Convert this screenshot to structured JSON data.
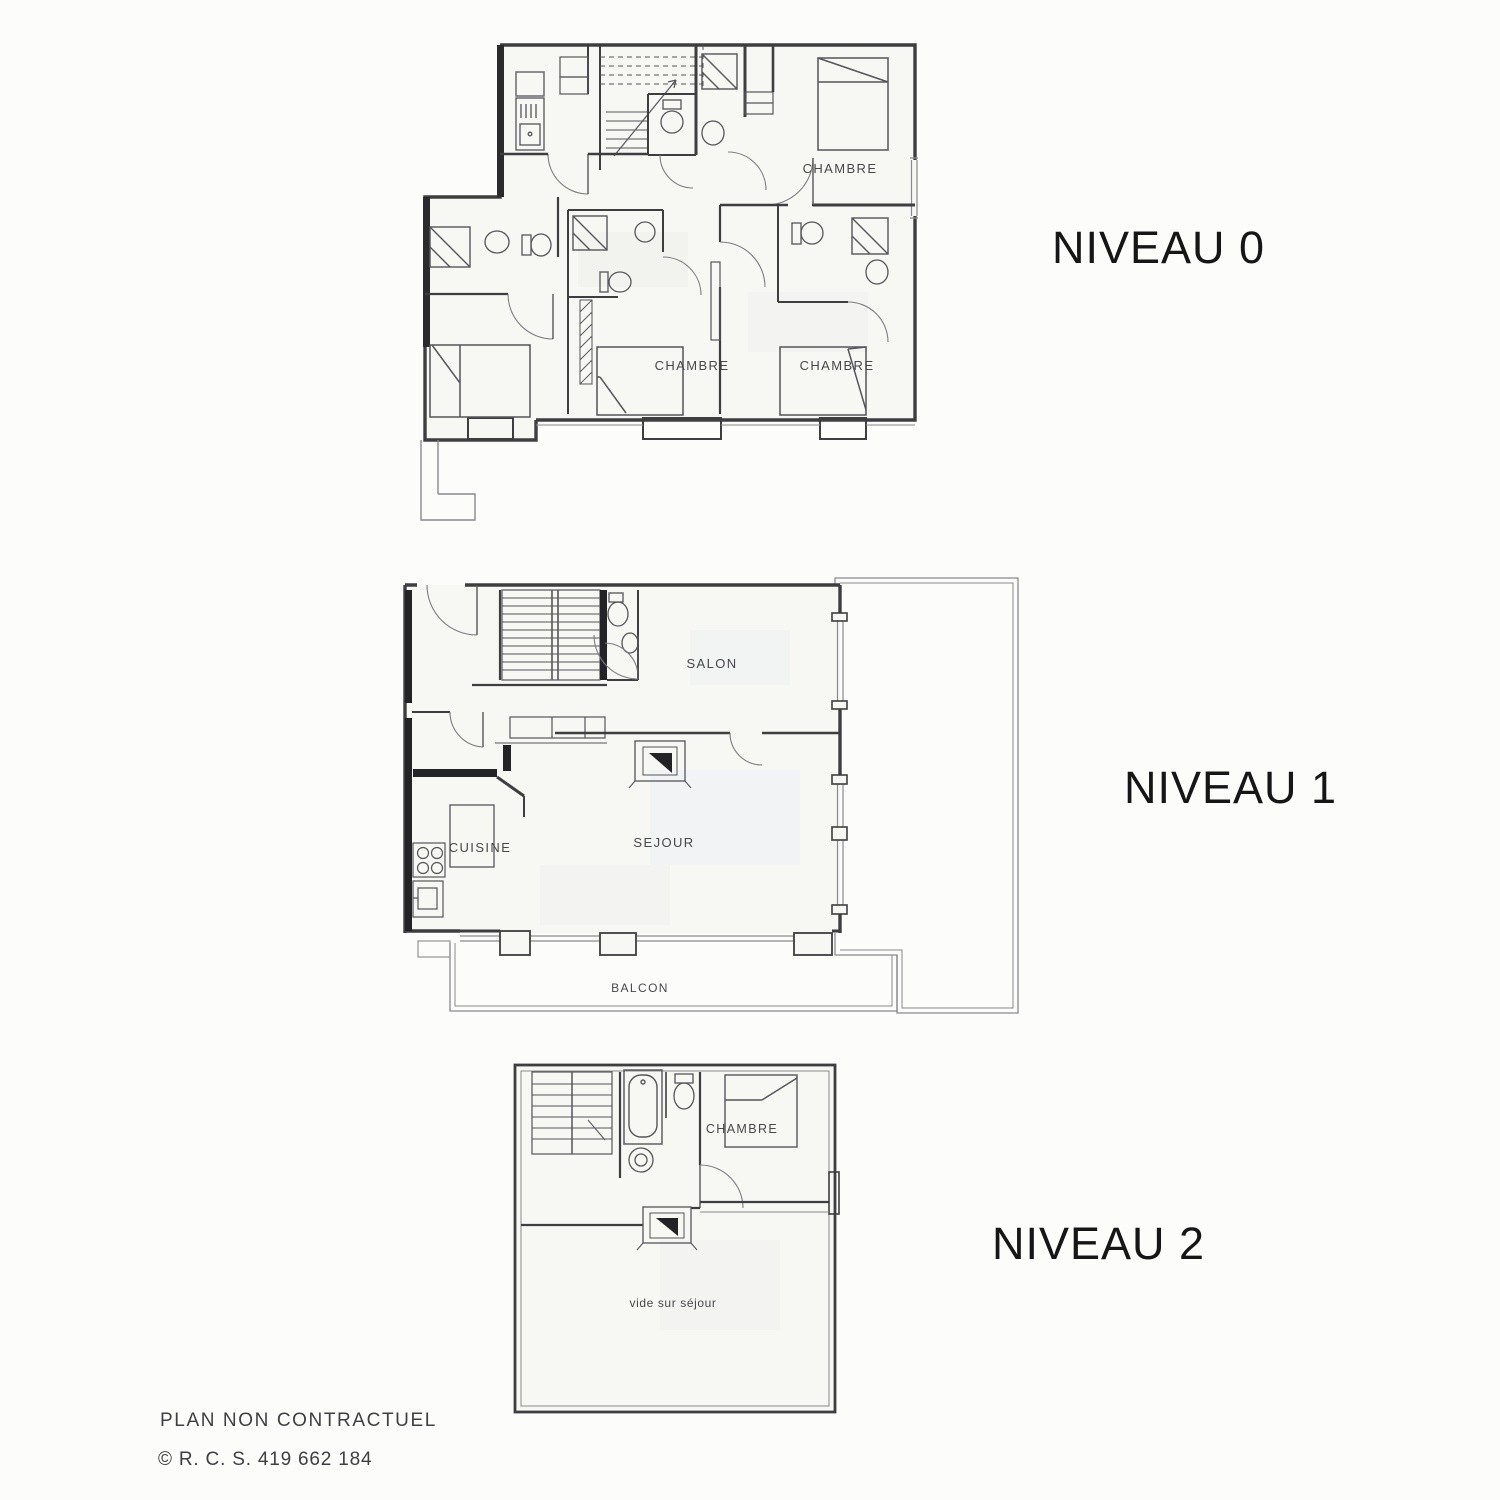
{
  "page": {
    "background": "#fcfcfb"
  },
  "levels": {
    "niveau0": {
      "title": "NIVEAU 0",
      "rooms": {
        "chambre_top_right": "CHAMBRE",
        "chambre_middle": "CHAMBRE",
        "chambre_bottom_right": "CHAMBRE"
      }
    },
    "niveau1": {
      "title": "NIVEAU 1",
      "rooms": {
        "salon": "SALON",
        "sejour": "SEJOUR",
        "cuisine": "CUISINE",
        "balcon": "BALCON"
      }
    },
    "niveau2": {
      "title": "NIVEAU 2",
      "rooms": {
        "chambre": "CHAMBRE",
        "vide_sur_sejour": "vide sur séjour"
      }
    }
  },
  "footer": {
    "disclaimer": "PLAN NON CONTRACTUEL",
    "registration": "© R. C. S. 419 662 184"
  },
  "colors": {
    "wall_ink": "#3e3e40",
    "poche_ink": "#2b2b2d",
    "paper": "#f7f7f4",
    "terrace_fill": "#f0f1f3",
    "label_ink": "#48484b",
    "title_ink": "#161616"
  }
}
